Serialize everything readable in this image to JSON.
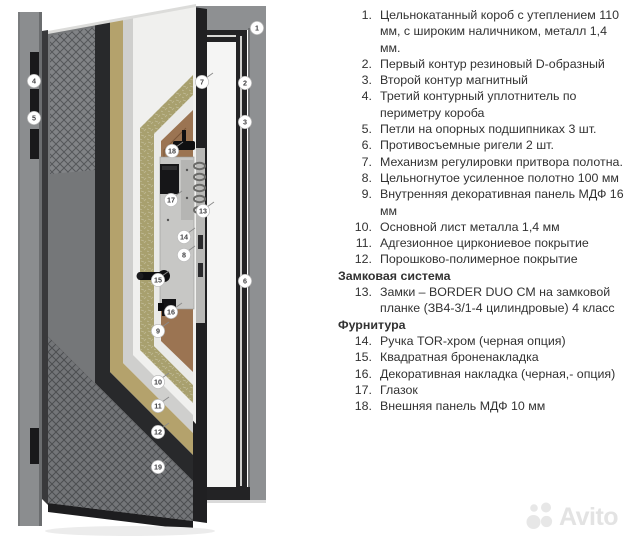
{
  "legend": {
    "entries": [
      {
        "type": "item",
        "label": "1.",
        "text": "Цельнокатанный короб с утеплением 110 мм, с широким наличником, металл 1,4 мм."
      },
      {
        "type": "item",
        "label": "2.",
        "text": "Первый контур резиновый D-образный"
      },
      {
        "type": "item",
        "label": "3.",
        "text": "Второй контур магнитный"
      },
      {
        "type": "item",
        "label": "4.",
        "text": "Третий контурный уплотнитель по периметру короба"
      },
      {
        "type": "item",
        "label": "5.",
        "text": "Петли на опорных подшипниках 3 шт."
      },
      {
        "type": "item",
        "label": "6.",
        "text": "Противосъемные ригели 2 шт."
      },
      {
        "type": "item",
        "label": "7.",
        "text": "Механизм регулировки притвора полотна."
      },
      {
        "type": "item",
        "label": "8.",
        "text": "Цельногнутое усиленное полотно 100 мм"
      },
      {
        "type": "item",
        "label": "9.",
        "text": "Внутренняя декоративная панель МДФ 16 мм"
      },
      {
        "type": "item",
        "label": "10.",
        "text": "Основной лист металла 1,4 мм"
      },
      {
        "type": "item",
        "label": "11.",
        "text": "Адгезионное циркониевое покрытие"
      },
      {
        "type": "item",
        "label": "12.",
        "text": "Порошково-полимерное покрытие"
      },
      {
        "type": "header",
        "text": "Замковая система"
      },
      {
        "type": "item",
        "label": "13.",
        "text": "Замки – BORDER DUO CM на замковой планке (ЗВ4-3/1-4 цилиндровые) 4 класс"
      },
      {
        "type": "header",
        "text": "Фурнитура"
      },
      {
        "type": "item",
        "label": "14.",
        "text": "Ручка TOR-хром (черная опция)"
      },
      {
        "type": "item",
        "label": "15.",
        "text": "Квадратная броненакладка"
      },
      {
        "type": "item",
        "label": "16.",
        "text": "Декоративная накладка (черная,- опция)"
      },
      {
        "type": "item",
        "label": "17.",
        "text": "Глазок"
      },
      {
        "type": "item",
        "label": "18.",
        "text": "Внешняя панель МДФ 10 мм"
      }
    ]
  },
  "diagram": {
    "markers": [
      {
        "n": "1",
        "x": 257,
        "y": 28,
        "tick": false
      },
      {
        "n": "2",
        "x": 245,
        "y": 83,
        "tick": false
      },
      {
        "n": "3",
        "x": 245,
        "y": 122,
        "tick": false
      },
      {
        "n": "4",
        "x": 34,
        "y": 81,
        "tick": false
      },
      {
        "n": "5",
        "x": 34,
        "y": 118,
        "tick": false
      },
      {
        "n": "6",
        "x": 245,
        "y": 281,
        "tick": false
      },
      {
        "n": "7",
        "x": 202,
        "y": 82,
        "tick": true
      },
      {
        "n": "8",
        "x": 184,
        "y": 255,
        "tick": true
      },
      {
        "n": "9",
        "x": 158,
        "y": 331,
        "tick": true
      },
      {
        "n": "10",
        "x": 158,
        "y": 382,
        "tick": true
      },
      {
        "n": "11",
        "x": 158,
        "y": 406,
        "tick": true
      },
      {
        "n": "12",
        "x": 158,
        "y": 432,
        "tick": true
      },
      {
        "n": "13",
        "x": 203,
        "y": 211,
        "tick": true
      },
      {
        "n": "14",
        "x": 184,
        "y": 237,
        "tick": true
      },
      {
        "n": "15",
        "x": 158,
        "y": 280,
        "tick": true
      },
      {
        "n": "16",
        "x": 171,
        "y": 312,
        "tick": true
      },
      {
        "n": "17",
        "x": 171,
        "y": 200,
        "tick": true
      },
      {
        "n": "18",
        "x": 172,
        "y": 151,
        "tick": true
      },
      {
        "n": "19",
        "x": 158,
        "y": 467,
        "tick": true
      }
    ],
    "colors": {
      "frame-gray": "#8e9092",
      "frame-edge": "#6e7072",
      "lining-black": "#232325",
      "opening-white": "#f5f5f4",
      "jamb-gray": "#8b8d8f",
      "leaf-face": "#757779",
      "pattern-base": "#818386",
      "pattern-line": "#55575a",
      "band-black": "#28292b",
      "band-tan": "#b4a26c",
      "band-gray": "#cfcfcd",
      "band-white": "#f0f0ee",
      "insul-green": "#a8a06e",
      "liner-white": "#eaeae8",
      "panel-brown": "#9b7452",
      "edge-black": "#202022",
      "metal-plate": "#c7c7c5",
      "marker-text": "#3f3f41"
    }
  },
  "watermark": {
    "text": "Avito"
  }
}
